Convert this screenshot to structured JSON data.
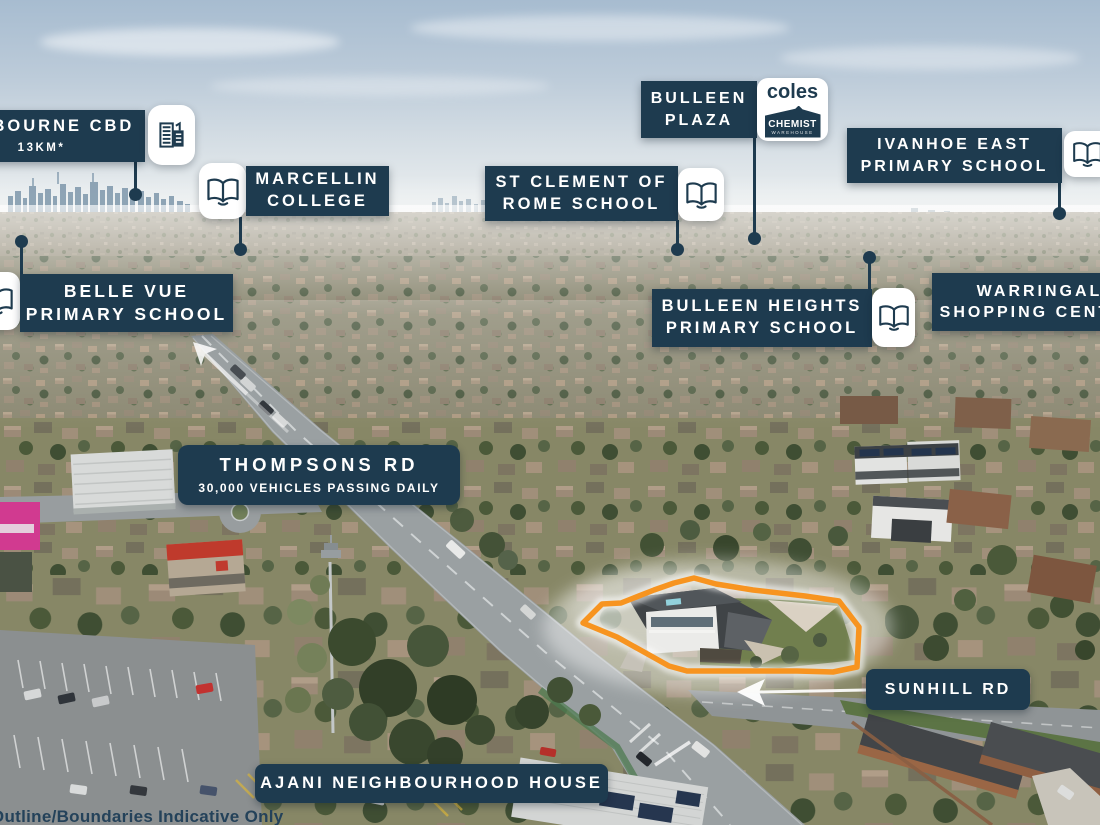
{
  "colors": {
    "navy": "#1e3b4f",
    "white": "#ffffff",
    "orange": "#f79420"
  },
  "icons": {
    "open_book": "open-book-icon",
    "city_buildings": "city-buildings-icon"
  },
  "annotations": {
    "melbourne_cbd": {
      "title": "MELBOURNE CBD",
      "subtitle": "13KM*"
    },
    "marcellin_college": {
      "line1": "MARCELLIN",
      "line2": "COLLEGE"
    },
    "bulleen_plaza": {
      "line1": "BULLEEN",
      "line2": "PLAZA"
    },
    "bulleen_plaza_logos": {
      "coles": "coles",
      "chemist_line1": "CHEMIST",
      "chemist_line2": "WAREHOUSE"
    },
    "st_clement": {
      "line1": "ST CLEMENT OF",
      "line2": "ROME SCHOOL"
    },
    "ivanhoe_east": {
      "line1": "IVANHOE EAST",
      "line2": "PRIMARY SCHOOL"
    },
    "belle_vue": {
      "line1": "BELLE VUE",
      "line2": "PRIMARY SCHOOL"
    },
    "bulleen_heights": {
      "line1": "BULLEEN HEIGHTS",
      "line2": "PRIMARY SCHOOL"
    },
    "warringal": {
      "line1": "WARRINGAL",
      "line2": "SHOPPING CENTRE"
    },
    "thompsons_rd": {
      "title": "THOMPSONS RD",
      "subtitle": "30,000 VEHICLES PASSING DAILY"
    },
    "sunhill_rd": {
      "title": "SUNHILL RD"
    },
    "ajani": {
      "title": "AJANI NEIGHBOURHOOD HOUSE"
    },
    "disclaimer": "*Outline/Boundaries Indicative Only"
  }
}
